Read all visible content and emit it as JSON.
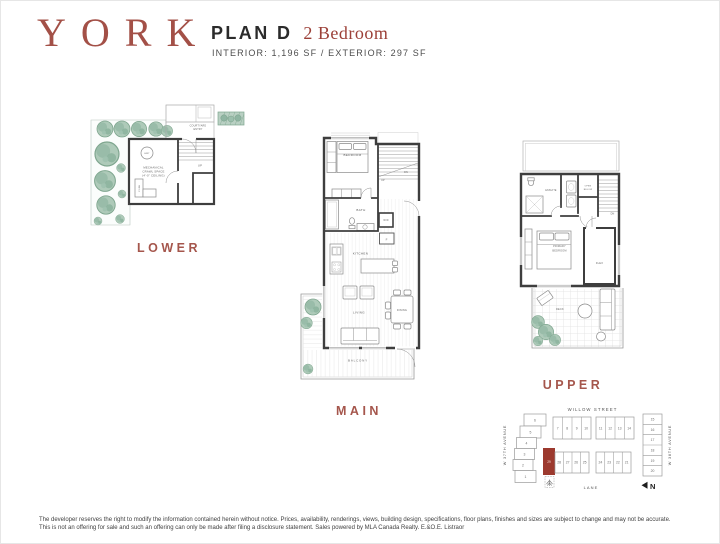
{
  "header": {
    "logo": "YORK",
    "plan_name": "PLAN D",
    "plan_type": "2 Bedroom",
    "specs": "INTERIOR: 1,196 SF / EXTERIOR: 297 SF"
  },
  "floors": {
    "lower": {
      "label": "LOWER",
      "courtyard": [
        "COURTYARD",
        "ENTRY"
      ],
      "mechanical": [
        "MECHANICAL",
        "CRAWL SPACE",
        "(4'-0\" CEILING)"
      ],
      "hwt": "HWT",
      "furn": "FURN",
      "up": "UP"
    },
    "main": {
      "label": "MAIN",
      "bedroom": "BEDROOM",
      "bath": "BATH",
      "wd": "W/D",
      "fridge": "F",
      "kitchen": "KITCHEN",
      "living": "LIVING",
      "dining": "DINING",
      "balcony": "BALCONY",
      "up": "UP",
      "dn": "DN"
    },
    "upper": {
      "label": "UPPER",
      "ensuite": "ENSUITE",
      "open_below": [
        "OPEN",
        "BELOW"
      ],
      "primary_bedroom": [
        "PRIMARY",
        "BEDROOM"
      ],
      "flex": "FLEX",
      "deck": "DECK",
      "dn": "DN"
    }
  },
  "siteplan": {
    "street_top": "WILLOW STREET",
    "street_bottom": "LANE",
    "avenue_left": "W 37TH AVENUE",
    "avenue_right": "W 38TH AVENUE",
    "north": "N",
    "highlighted_lot": "29",
    "highlight_color": "#9c392e",
    "lots": [
      "1",
      "2",
      "3",
      "4",
      "5",
      "6",
      "7",
      "8",
      "9",
      "10",
      "11",
      "12",
      "13",
      "14",
      "15",
      "16",
      "17",
      "18",
      "19",
      "20",
      "21",
      "22",
      "23",
      "24",
      "25",
      "26",
      "27",
      "28",
      "29"
    ]
  },
  "footer": {
    "line1": "The developer reserves the right to modify the information contained herein without notice. Prices, availability, renderings, views, building design, specifications, floor plans, finishes and sizes are subject to change and may not be accurate.",
    "line2": "This is not an offering for sale and such an offering can only be made after filing a disclosure statement. Sales powered by MLA Canada Realty. E.&O.E. Listraor"
  }
}
